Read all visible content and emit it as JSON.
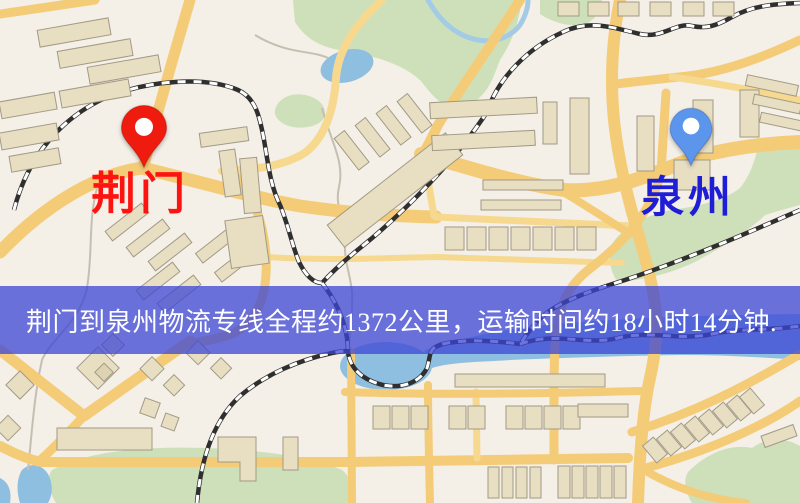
{
  "banner": {
    "text": "荆门到泉州物流专线全程约1372公里，运输时间约18小时14分钟.",
    "background": "rgba(60,69,213,0.75)",
    "text_color": "#ffffff"
  },
  "route": {
    "origin_city": "荆门",
    "destination_city": "泉州",
    "service": "物流专线",
    "distance_km": "1372",
    "duration": "18小时14分钟"
  },
  "markers": {
    "origin": {
      "name": "荆门",
      "pin_color": "#ee1b0e",
      "pin_hole_color": "#ffffff",
      "label_color": "#fd1410"
    },
    "destination": {
      "name": "泉州",
      "pin_color": "#5b95ec",
      "pin_hole_color": "#ffffff",
      "label_color": "#1e1ed6"
    }
  },
  "map": {
    "colors": {
      "background": "#f4efe7",
      "road": "#f4cc78",
      "road_minor": "#f6d88f",
      "building": "#e8dfc3",
      "building_light": "#efe8d6",
      "green": "#cde0ba",
      "water": "#8fbfe0",
      "railway_dark": "#2f2f2f",
      "railway_light": "#ffffff"
    }
  }
}
